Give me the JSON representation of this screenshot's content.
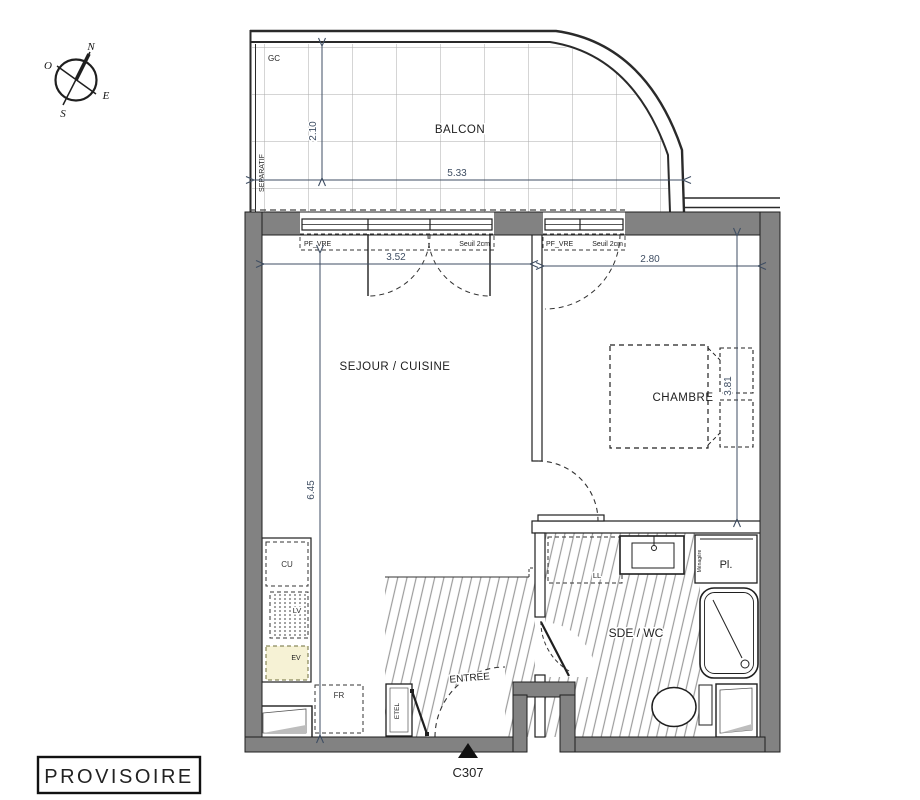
{
  "labels": {
    "balcon": "BALCON",
    "sejour": "SEJOUR / CUISINE",
    "chambre": "CHAMBRE",
    "sde": "SDE / WC",
    "entree": "ENTREE",
    "pl": "Pl.",
    "pl_small": "Ménagère",
    "gc": "GC",
    "separatif": "SEPARATIF",
    "pf_vre": "PF_VRE",
    "seuil": "Seuil 2cm",
    "cu": "CU",
    "lv": "LV",
    "ev": "EV",
    "fr": "FR",
    "ll": "LL",
    "etel": "ETEL"
  },
  "dims": {
    "balcon_depth": "2.10",
    "balcon_width": "5.33",
    "sejour_width": "3.52",
    "chambre_width": "2.80",
    "sejour_depth": "6.45",
    "chambre_depth": "3.81"
  },
  "compass": {
    "n": "N",
    "e": "E",
    "s": "S",
    "o": "O"
  },
  "footer": {
    "unit": "C307",
    "stamp": "PROVISOIRE"
  },
  "colors": {
    "wall_fill": "#828282",
    "dimension_text": "#3f4e63",
    "ev_highlight": "#f6f2d5",
    "hatch_line": "#9c9c9c",
    "tile_line": "#ababab"
  }
}
